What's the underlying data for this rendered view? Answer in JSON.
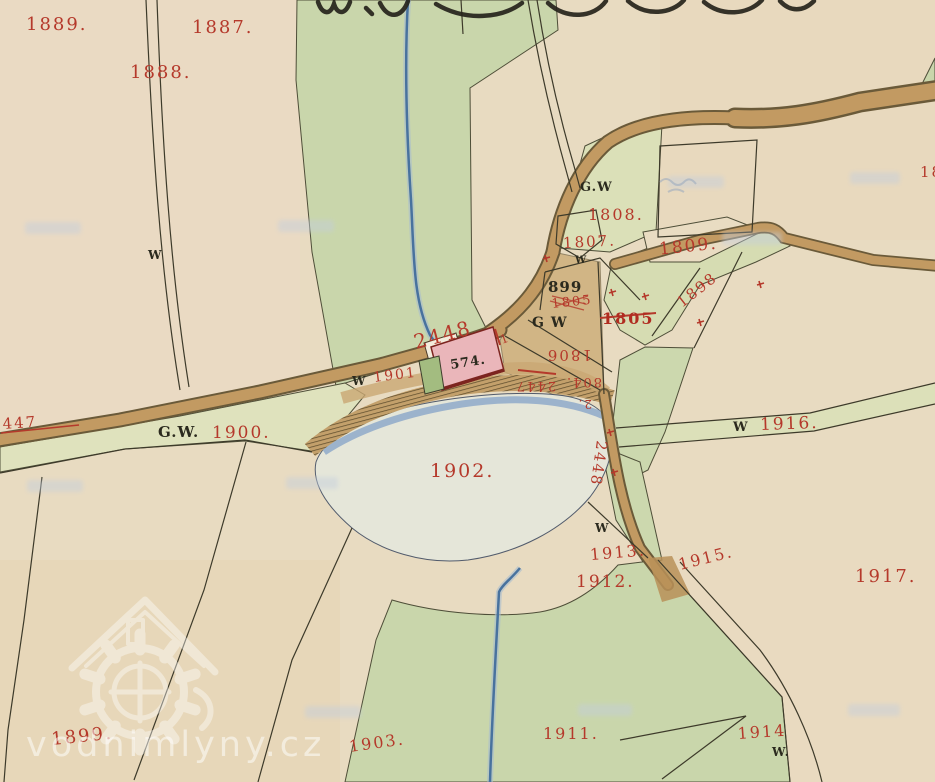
{
  "map_type": "historical cadastral map scan",
  "watermark": {
    "site": "vodnimlyny.cz"
  },
  "colors": {
    "paper": "#e8dbc1",
    "field_green": "#c9d6ab",
    "verge_green": "#dbe0b8",
    "road_brown": "#c29a62",
    "road_edge": "#6a5a39",
    "pond_fill": "#e5e7db",
    "water_blue": "#48729e",
    "pond_edge_blue": "#8fa9c9",
    "building_pink": "#eab6ba",
    "building_outline": "#7c241f",
    "parcel_red": "#b5392b",
    "ink_black": "#2b2a1e"
  },
  "labels": {
    "p1889": "1889.",
    "p1887": "1887.",
    "p1888": "1888.",
    "p1808": "1808.",
    "p1807": "1807.",
    "p1809": "1809.",
    "p1898": "1898",
    "p899": "899",
    "gw_upper": "G.W",
    "gw_mill_yard": "G W",
    "p1805_old": "1805",
    "p1805_new": "1805",
    "p1806": "1806",
    "p2447": "2447",
    "p804": "804.",
    "p2": "2.",
    "p2448_road": "2448",
    "p2448_after": "1",
    "p574": "574.",
    "p1901": "1901",
    "w_mill": "W",
    "p447": "447",
    "gw_1900": "G.W.",
    "p1900": "1900.",
    "p1902": "1902.",
    "w_1916": "W",
    "p1916": "1916.",
    "p2448_south": "2448",
    "w_south": "W",
    "p1913": "1913.",
    "p1912": "1912.",
    "p1915": "1915.",
    "p1917": "1917.",
    "p1899": "1899.",
    "p1903": "1903.",
    "p1911": "1911.",
    "p1914": "1914",
    "w_1914": "W.",
    "w_path": "W",
    "w_1807": "W",
    "p_edge_partial": "18"
  }
}
